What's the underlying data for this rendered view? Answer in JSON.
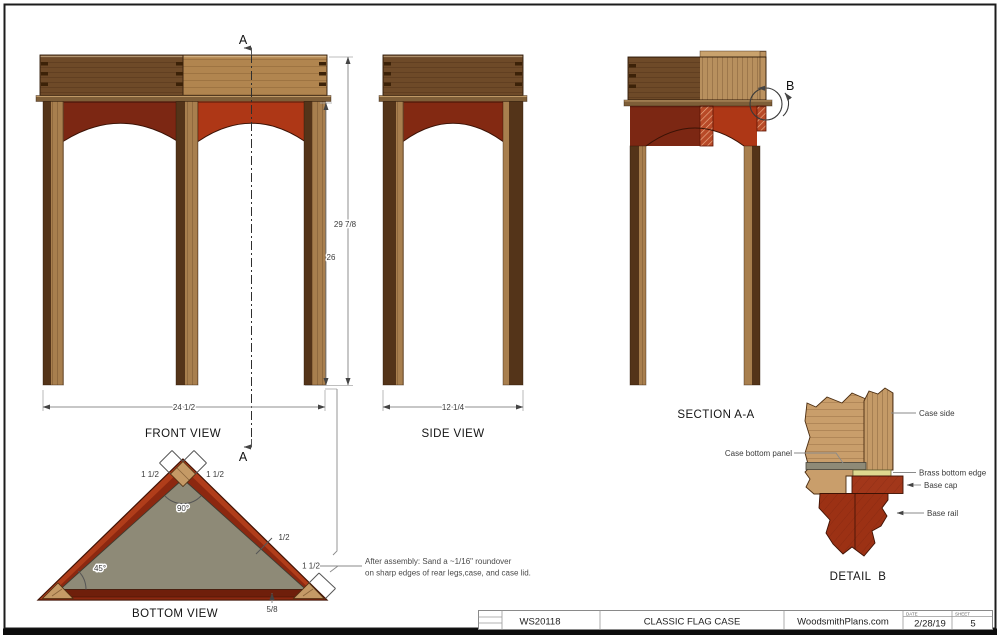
{
  "drawing": {
    "front_view": {
      "label": "FRONT VIEW",
      "section_letter": "A",
      "dim_width": "24 1/2",
      "dim_height_overall": "29 7/8",
      "dim_height_base": "26"
    },
    "side_view": {
      "label": "SIDE VIEW",
      "dim_width": "12 1/4"
    },
    "section_view": {
      "label": "SECTION A-A",
      "detail_letter": "B"
    },
    "bottom_view": {
      "label": "BOTTOM VIEW",
      "dim_corner_left": "1 1/2",
      "dim_corner_right": "1 1/2",
      "angle_apex": "90°",
      "angle_base": "45°",
      "dim_frame": "1/2",
      "dim_corner_block": "1 1/2",
      "dim_back_rail": "5/8"
    },
    "detail_view": {
      "label": "DETAIL  B",
      "callout_case_side": "Case side",
      "callout_case_bottom_panel": "Case bottom panel",
      "callout_brass_bottom_edge": "Brass bottom edge",
      "callout_base_cap": "Base cap",
      "callout_base_rail": "Base rail"
    },
    "note_line1": "After assembly: Sand a ~1/16\" roundover",
    "note_line2": "on sharp edges of rear legs,case, and case lid."
  },
  "title_block": {
    "plan_number": "WS20118",
    "project_title": "CLASSIC FLAG CASE",
    "website": "WoodsmithPlans.com",
    "date_label": "DATE",
    "date_value": "2/28/19",
    "sheet_label": "SHEET",
    "sheet_value": "5"
  },
  "colors": {
    "wood_dark": "#6e4a28",
    "wood_light": "#b1854f",
    "apron_maroon": "#7c2713",
    "apron_red": "#ae3716",
    "panel_gray": "#8e8a77",
    "brass": "#ded98f",
    "base_red": "#a2371a",
    "dim_gray": "#8f8f8f",
    "border_black": "#111111"
  }
}
